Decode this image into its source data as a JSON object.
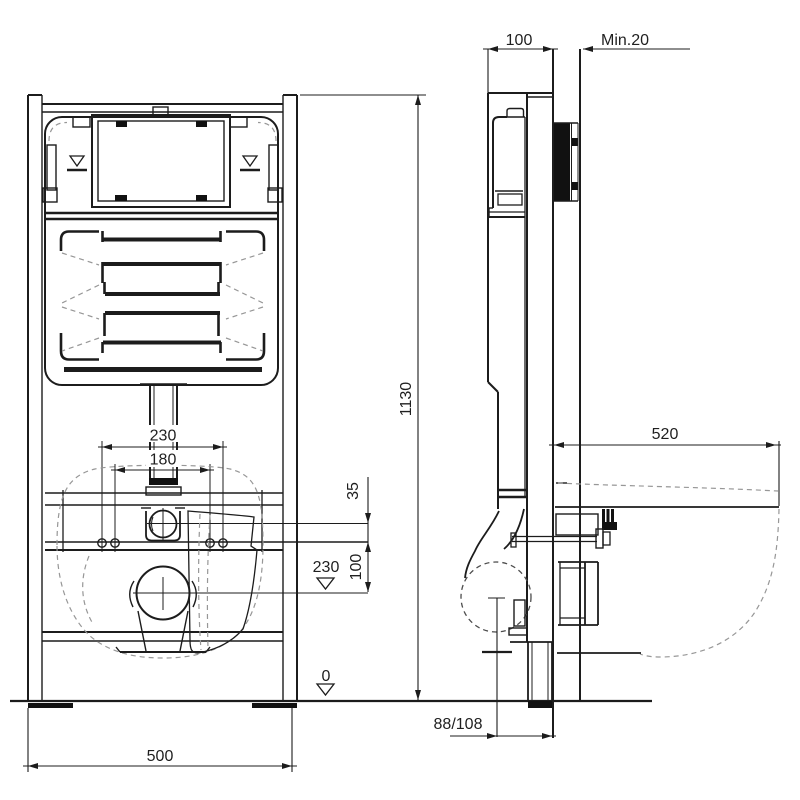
{
  "drawing": {
    "title": "wall-hung-wc-frame-installation-drawing",
    "front_view": {
      "dim_bolt_spacing_outer": "230",
      "dim_bolt_spacing_inner": "180",
      "dim_supply_offset": "35",
      "dim_bolt_to_outlet": "100",
      "dim_outlet_height": "230",
      "dim_floor_level": "0",
      "dim_frame_width": "500"
    },
    "side_view": {
      "dim_frame_depth": "100",
      "dim_wall_min": "Min.20",
      "dim_frame_height": "1130",
      "dim_bowl_depth": "520",
      "dim_outlet_pipe": "88/108"
    },
    "colors": {
      "line": "#1c1c1c",
      "background": "#ffffff"
    }
  }
}
